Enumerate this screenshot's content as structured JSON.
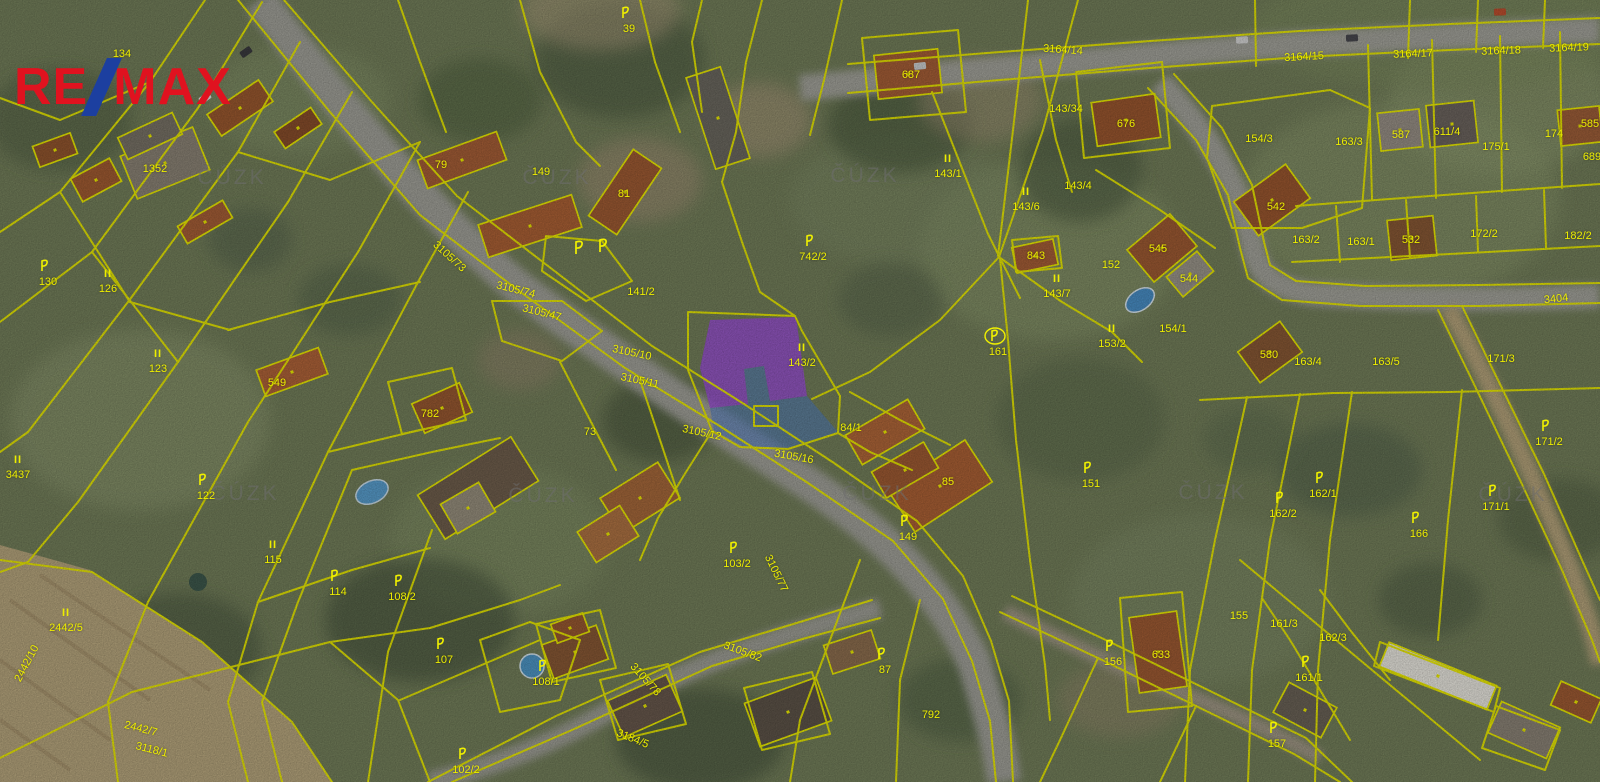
{
  "app": {
    "type": "cadastral-aerial-map"
  },
  "logo": {
    "part1": "RE",
    "slash": "/",
    "part2": "MAX",
    "red": "#e0121f",
    "blue": "#1c3fa0"
  },
  "map": {
    "watermark_text": "ČÚZK",
    "watermarks": [
      {
        "x": 232,
        "y": 177
      },
      {
        "x": 557,
        "y": 177
      },
      {
        "x": 865,
        "y": 175
      },
      {
        "x": 245,
        "y": 493
      },
      {
        "x": 543,
        "y": 495
      },
      {
        "x": 877,
        "y": 493
      },
      {
        "x": 1213,
        "y": 492
      },
      {
        "x": 1513,
        "y": 494
      }
    ],
    "line_color": "#f0f000",
    "label_color": "#eded00",
    "highlight": {
      "building_fill": "#9d4ede",
      "building_opacity": 0.8,
      "parcel_fill": "#4d7fd0",
      "parcel_opacity": 0.55
    },
    "flags": [
      {
        "x": 580,
        "y": 248
      },
      {
        "x": 604,
        "y": 246
      }
    ],
    "labels": [
      {
        "t": "134",
        "x": 122,
        "y": 53
      },
      {
        "t": "1352",
        "x": 155,
        "y": 168
      },
      {
        "t": "130",
        "x": 48,
        "y": 281,
        "p": 1
      },
      {
        "t": "126",
        "x": 108,
        "y": 288,
        "i": 1
      },
      {
        "t": "123",
        "x": 158,
        "y": 368,
        "i": 1
      },
      {
        "t": "122",
        "x": 206,
        "y": 495,
        "p": 1
      },
      {
        "t": "3437",
        "x": 18,
        "y": 474,
        "i": 1
      },
      {
        "t": "2442/5",
        "x": 66,
        "y": 627,
        "i": 1
      },
      {
        "t": "115",
        "x": 273,
        "y": 559,
        "i": 1
      },
      {
        "t": "114",
        "x": 338,
        "y": 591,
        "p": 1
      },
      {
        "t": "108/2",
        "x": 402,
        "y": 596,
        "p": 1
      },
      {
        "t": "107",
        "x": 444,
        "y": 659,
        "p": 1
      },
      {
        "t": "102/2",
        "x": 466,
        "y": 769,
        "p": 1
      },
      {
        "t": "108/1",
        "x": 546,
        "y": 681,
        "p": 1
      },
      {
        "t": "2442/10",
        "x": 26,
        "y": 663,
        "r": -62
      },
      {
        "t": "2442/7",
        "x": 141,
        "y": 728,
        "r": 14
      },
      {
        "t": "3118/1",
        "x": 152,
        "y": 749,
        "r": 14
      },
      {
        "t": "3184/5",
        "x": 633,
        "y": 738,
        "r": 22
      },
      {
        "t": "3105/82",
        "x": 743,
        "y": 651,
        "r": 20
      },
      {
        "t": "3105/78",
        "x": 646,
        "y": 679,
        "r": 48
      },
      {
        "t": "549",
        "x": 277,
        "y": 382
      },
      {
        "t": "782",
        "x": 430,
        "y": 413
      },
      {
        "t": "79",
        "x": 441,
        "y": 164
      },
      {
        "t": "149",
        "x": 541,
        "y": 171
      },
      {
        "t": "81",
        "x": 624,
        "y": 193
      },
      {
        "t": "39",
        "x": 629,
        "y": 28,
        "p": 1
      },
      {
        "t": "73",
        "x": 590,
        "y": 431
      },
      {
        "t": "3105/73",
        "x": 450,
        "y": 256,
        "r": 42
      },
      {
        "t": "3105/74",
        "x": 516,
        "y": 289,
        "r": 14
      },
      {
        "t": "3105/47",
        "x": 542,
        "y": 312,
        "r": 14
      },
      {
        "t": "3105/10",
        "x": 632,
        "y": 352,
        "r": 12
      },
      {
        "t": "3105/11",
        "x": 640,
        "y": 380,
        "r": 12
      },
      {
        "t": "3105/12",
        "x": 702,
        "y": 432,
        "r": 12
      },
      {
        "t": "3105/16",
        "x": 794,
        "y": 456,
        "r": 10
      },
      {
        "t": "3105/77",
        "x": 777,
        "y": 573,
        "r": 64
      },
      {
        "t": "141/2",
        "x": 641,
        "y": 291
      },
      {
        "t": "143/2",
        "x": 802,
        "y": 362,
        "i": 1
      },
      {
        "t": "84/1",
        "x": 851,
        "y": 427
      },
      {
        "t": "149",
        "x": 908,
        "y": 536,
        "p": 1
      },
      {
        "t": "85",
        "x": 948,
        "y": 481
      },
      {
        "t": "103/2",
        "x": 737,
        "y": 563,
        "p": 1
      },
      {
        "t": "151",
        "x": 1091,
        "y": 483,
        "p": 1
      },
      {
        "t": "143/1",
        "x": 948,
        "y": 173,
        "i": 1
      },
      {
        "t": "143/34",
        "x": 1066,
        "y": 108
      },
      {
        "t": "687",
        "x": 911,
        "y": 74
      },
      {
        "t": "676",
        "x": 1126,
        "y": 123
      },
      {
        "t": "143/4",
        "x": 1078,
        "y": 185
      },
      {
        "t": "143/6",
        "x": 1026,
        "y": 206,
        "i": 1
      },
      {
        "t": "143/7",
        "x": 1057,
        "y": 293,
        "i": 1
      },
      {
        "t": "742/2",
        "x": 813,
        "y": 256,
        "p": 1
      },
      {
        "t": "152",
        "x": 1111,
        "y": 264
      },
      {
        "t": "545",
        "x": 1158,
        "y": 248
      },
      {
        "t": "843",
        "x": 1036,
        "y": 255
      },
      {
        "t": "544",
        "x": 1189,
        "y": 278
      },
      {
        "t": "154/1",
        "x": 1173,
        "y": 328
      },
      {
        "t": "153/2",
        "x": 1112,
        "y": 343,
        "i": 1
      },
      {
        "t": "161",
        "x": 998,
        "y": 351,
        "p": 1,
        "o": 1
      },
      {
        "t": "3164/14",
        "x": 1063,
        "y": 49,
        "r": 4
      },
      {
        "t": "3164/15",
        "x": 1304,
        "y": 56,
        "r": -3
      },
      {
        "t": "3164/17",
        "x": 1413,
        "y": 53,
        "r": -2
      },
      {
        "t": "3164/18",
        "x": 1501,
        "y": 50,
        "r": -2
      },
      {
        "t": "3164/19",
        "x": 1569,
        "y": 47,
        "r": -2
      },
      {
        "t": "154/3",
        "x": 1259,
        "y": 138
      },
      {
        "t": "587",
        "x": 1401,
        "y": 134
      },
      {
        "t": "611/4",
        "x": 1447,
        "y": 131
      },
      {
        "t": "174",
        "x": 1554,
        "y": 133
      },
      {
        "t": "175/1",
        "x": 1496,
        "y": 146
      },
      {
        "t": "163/3",
        "x": 1349,
        "y": 141
      },
      {
        "t": "585",
        "x": 1590,
        "y": 123
      },
      {
        "t": "689",
        "x": 1592,
        "y": 156
      },
      {
        "t": "542",
        "x": 1276,
        "y": 206
      },
      {
        "t": "163/2",
        "x": 1306,
        "y": 239
      },
      {
        "t": "163/1",
        "x": 1361,
        "y": 241
      },
      {
        "t": "532",
        "x": 1411,
        "y": 239
      },
      {
        "t": "172/2",
        "x": 1484,
        "y": 233
      },
      {
        "t": "182/2",
        "x": 1578,
        "y": 235
      },
      {
        "t": "3404",
        "x": 1556,
        "y": 298,
        "r": -6
      },
      {
        "t": "580",
        "x": 1269,
        "y": 354
      },
      {
        "t": "163/4",
        "x": 1308,
        "y": 361
      },
      {
        "t": "163/5",
        "x": 1386,
        "y": 361
      },
      {
        "t": "171/3",
        "x": 1501,
        "y": 358
      },
      {
        "t": "171/2",
        "x": 1549,
        "y": 441,
        "p": 1
      },
      {
        "t": "162/1",
        "x": 1323,
        "y": 493,
        "p": 1
      },
      {
        "t": "162/2",
        "x": 1283,
        "y": 513,
        "p": 1
      },
      {
        "t": "166",
        "x": 1419,
        "y": 533,
        "p": 1
      },
      {
        "t": "171/1",
        "x": 1496,
        "y": 506,
        "p": 1
      },
      {
        "t": "156",
        "x": 1113,
        "y": 661,
        "p": 1
      },
      {
        "t": "633",
        "x": 1161,
        "y": 654
      },
      {
        "t": "155",
        "x": 1239,
        "y": 615
      },
      {
        "t": "161/3",
        "x": 1284,
        "y": 623
      },
      {
        "t": "162/3",
        "x": 1333,
        "y": 637
      },
      {
        "t": "161/1",
        "x": 1309,
        "y": 677,
        "p": 1
      },
      {
        "t": "157",
        "x": 1277,
        "y": 743,
        "p": 1
      },
      {
        "t": "87",
        "x": 885,
        "y": 669,
        "p": 1
      },
      {
        "t": "792",
        "x": 931,
        "y": 714
      }
    ]
  }
}
